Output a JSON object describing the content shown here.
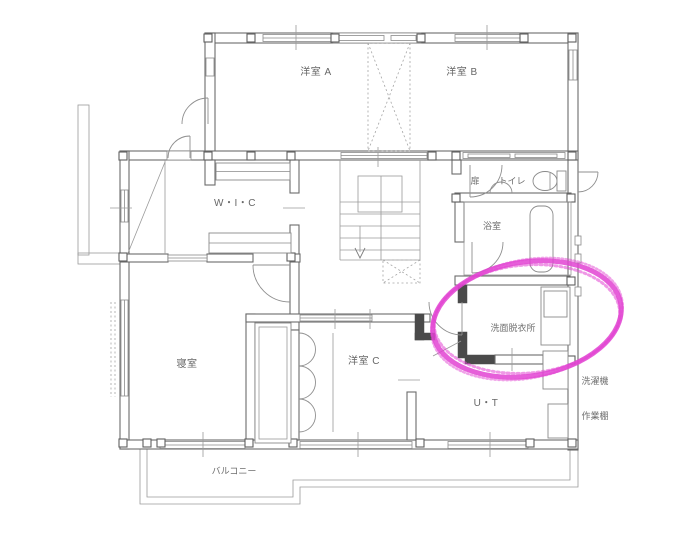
{
  "plan": {
    "labels": {
      "room_a": "洋室 A",
      "room_b": "洋室 B",
      "door": "扉",
      "toilet": "トイレ",
      "bath": "浴室",
      "wic": "W・I・C",
      "washroom": "洗面脱衣所",
      "bedroom": "寝室",
      "room_c": "洋室 C",
      "ut": "U・T",
      "balcony": "バルコニー",
      "washer": "洗濯機",
      "work_shelf": "作業棚"
    },
    "highlight": {
      "color": "#e243d2",
      "shape": "hand-drawn-marker-ellipse"
    },
    "colors": {
      "wall_line": "#6b6b6b",
      "thin_line": "#979797",
      "text": "#676767"
    }
  }
}
